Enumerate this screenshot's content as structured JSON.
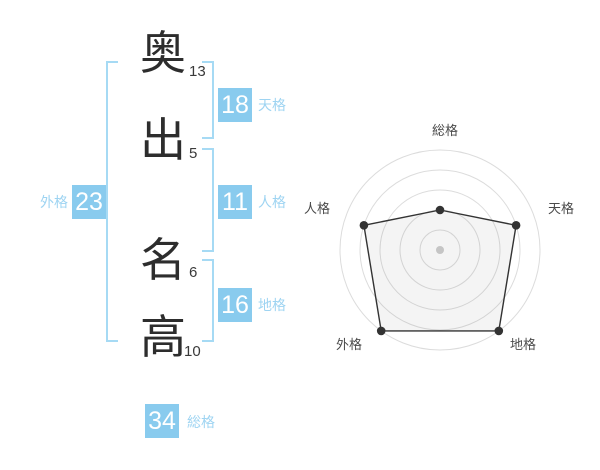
{
  "name_panel": {
    "characters": [
      {
        "char": "奥",
        "strokes": "13"
      },
      {
        "char": "出",
        "strokes": "5"
      },
      {
        "char": "名",
        "strokes": "6"
      },
      {
        "char": "高",
        "strokes": "10"
      }
    ],
    "tenkaku": {
      "value": "18",
      "label": "天格"
    },
    "jinkaku": {
      "value": "11",
      "label": "人格"
    },
    "chikaku": {
      "value": "16",
      "label": "地格"
    },
    "gaikaku": {
      "value": "23",
      "label": "外格"
    },
    "soukaku": {
      "value": "34",
      "label": "総格"
    }
  },
  "colors": {
    "box_blue": "#89cbee",
    "label_blue": "#9ed4f2",
    "bracket_blue": "#a6daf4",
    "kanji_dark": "#2d2d2d"
  },
  "chart_data": {
    "type": "radar",
    "categories": [
      "総格",
      "天格",
      "地格",
      "外格",
      "人格"
    ],
    "values": [
      2,
      4,
      5,
      5,
      4
    ],
    "max": 5,
    "rings": 5,
    "start_angle_deg": -90,
    "grid": true,
    "grid_color": "#dcdcdc",
    "line_color": "#333333",
    "fill_color": "rgba(100,100,100,0.07)",
    "point_color": "#333333",
    "center_dot_color": "#c5c5c5",
    "label_color": "#4a4a4a",
    "label_font_px": 13,
    "center": [
      143,
      140
    ],
    "radius": 100,
    "label_anchors": [
      {
        "x": 148,
        "y": 25,
        "anchor": "middle"
      },
      {
        "x": 251,
        "y": 103,
        "anchor": "start"
      },
      {
        "x": 213,
        "y": 239,
        "anchor": "start"
      },
      {
        "x": 65,
        "y": 239,
        "anchor": "end"
      },
      {
        "x": 33,
        "y": 103,
        "anchor": "end"
      }
    ]
  }
}
